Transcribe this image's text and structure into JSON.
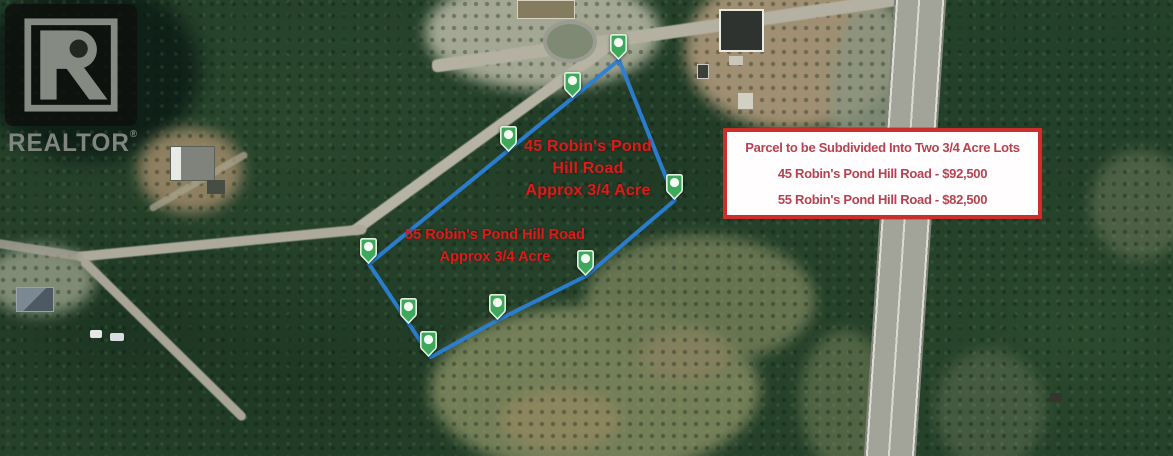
{
  "watermark": {
    "brand": "REALTOR",
    "registered_mark": "®"
  },
  "parcel_labels": [
    {
      "name": "lot-45-label",
      "lines": [
        "45 Robin's Pond",
        "Hill Road",
        "Approx 3/4 Acre"
      ]
    },
    {
      "name": "lot-55-label",
      "lines": [
        "55 Robin's Pond Hill Road",
        "Approx 3/4 Acre"
      ]
    }
  ],
  "info_box": {
    "lines": [
      "Parcel to be Subdivided Into Two 3/4 Acre Lots",
      "45 Robin's Pond Hill Road - $92,500",
      "55 Robin's Pond Hill Road - $82,500"
    ],
    "border_color": "#cb2f2a",
    "background": "#fffdfd",
    "text_color": "#b8414f"
  },
  "overlay": {
    "line_color": "#2b7fd6",
    "pin_color": "#3da75c",
    "label_color": "#dd1b1b",
    "polygon_points": "619,60 675,200 586,276 498,320 431,357 369,264",
    "pins": [
      {
        "x": 618,
        "y": 46
      },
      {
        "x": 572,
        "y": 84
      },
      {
        "x": 508,
        "y": 138
      },
      {
        "x": 674,
        "y": 186
      },
      {
        "x": 368,
        "y": 250
      },
      {
        "x": 585,
        "y": 262
      },
      {
        "x": 497,
        "y": 306
      },
      {
        "x": 408,
        "y": 310
      },
      {
        "x": 428,
        "y": 343
      }
    ]
  }
}
